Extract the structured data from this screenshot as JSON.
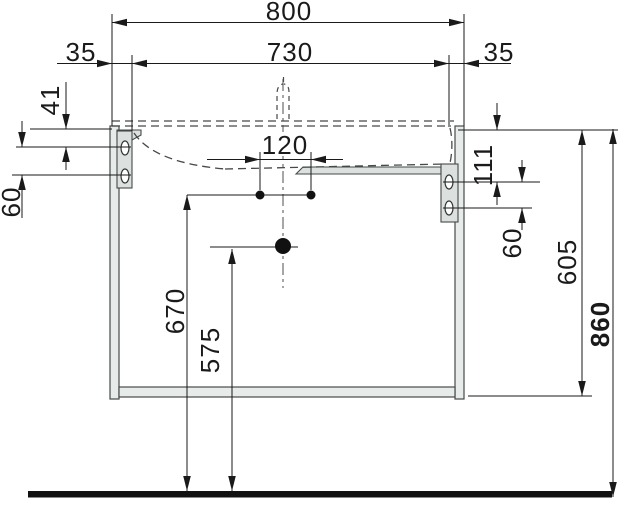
{
  "labels": {
    "w800": "800",
    "w730": "730",
    "off35l": "35",
    "off35r": "35",
    "tap120": "120",
    "left41": "41",
    "left60": "60",
    "right111": "111",
    "right60": "60",
    "h605": "605",
    "h860": "860",
    "h670": "670",
    "h575": "575"
  },
  "colors": {
    "line": "#1a1a1a",
    "panel_fill": "#e7ebea",
    "panel_stroke": "#454948",
    "dashed": "#45494 8",
    "floor": "#111111"
  }
}
